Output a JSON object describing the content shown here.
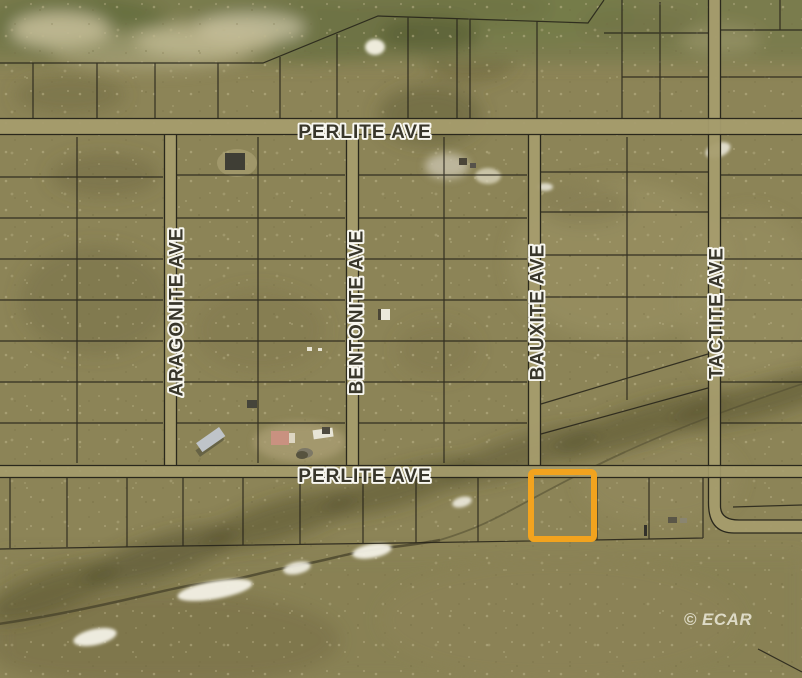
{
  "map": {
    "streets": {
      "perlite_top": "PERLITE AVE",
      "aragonite": "ARAGONITE AVE",
      "bentonite": "BENTONITE AVE",
      "bauxite": "BAUXITE AVE",
      "tactite": "TACTITE AVE",
      "perlite_bottom": "PERLITE AVE"
    },
    "watermark": "© ECAR",
    "highlight_color": "#F2A31E",
    "colors": {
      "terrain": "#8C8457",
      "road_fill": "#A59C6D",
      "boundary_line": "#232117",
      "label_fill": "#38362A",
      "label_outline": "#F8F7F0",
      "drainage": "#544F2E",
      "snow": "#F3F1E6"
    }
  }
}
